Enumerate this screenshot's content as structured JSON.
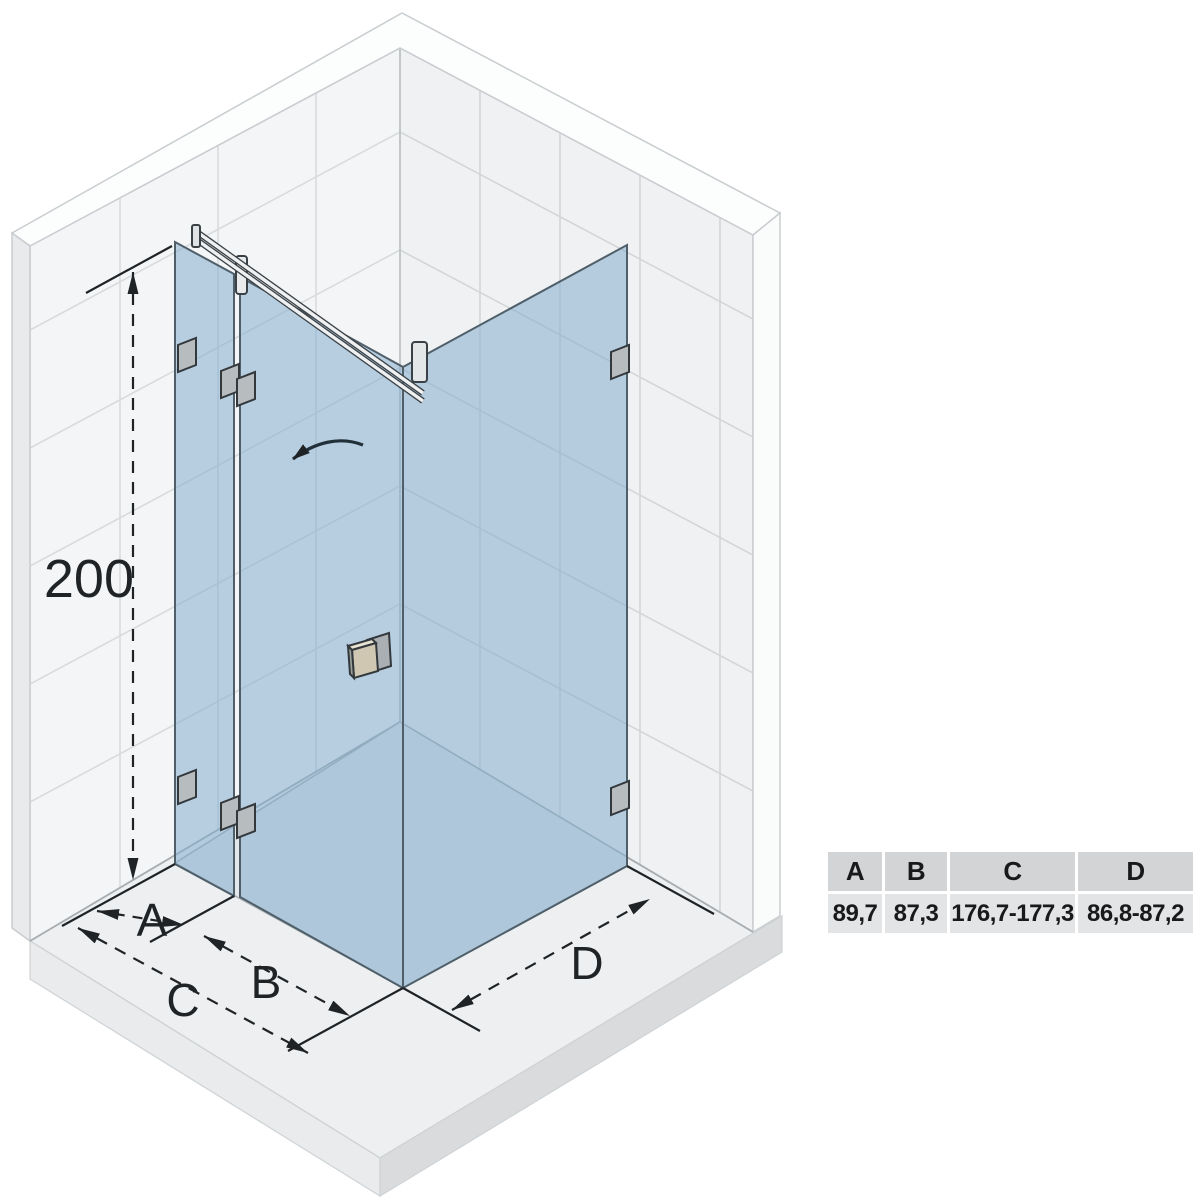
{
  "diagram": {
    "type": "shower-enclosure-installation-drawing",
    "labels": {
      "height": "200",
      "dim_a": "A",
      "dim_b": "B",
      "dim_c": "C",
      "dim_d": "D"
    },
    "icons": [
      "door-swing-arrow-icon",
      "dimension-arrowheads"
    ],
    "colors": {
      "glass_blue": "#b7cee1",
      "glass_edge": "#4f5f6a",
      "wall_white": "#f3f4f5",
      "tile_grout": "#d6d9db",
      "floor_gray": "#edeff0",
      "floor_side_shade": "#d9dbdd",
      "hardware_gray": "#b7bcbf",
      "handle_beige": "#cfc7b2",
      "dimension_line": "#2a2a2a",
      "table_header_bg": "#d2d4d6",
      "table_value_bg": "#e2e4e5"
    }
  },
  "table": {
    "headers": [
      "A",
      "B",
      "C",
      "D"
    ],
    "values": [
      "89,7",
      "87,3",
      "176,7-177,3",
      "86,8-87,2"
    ]
  }
}
